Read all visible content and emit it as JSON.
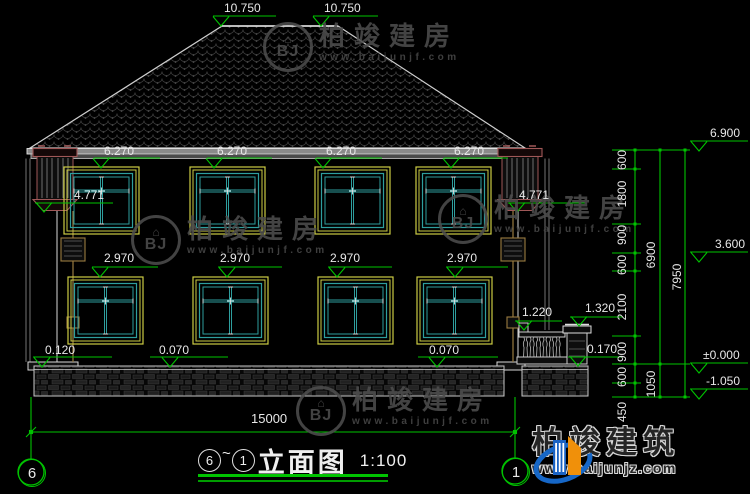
{
  "canvas": {
    "width": 750,
    "height": 494
  },
  "colors": {
    "background": "#000000",
    "dimension_green": "#00c300",
    "text_white": "#e8e8e8",
    "window_frame_yellow": "#cccc44",
    "window_frame_teal": "#2e9e9e",
    "pilaster_brown": "#a05858",
    "downspout_brown": "#9a7b40",
    "watermark_gray": "#4d4d4d",
    "brand_blue": "#1667c7",
    "brand_orange": "#f0900a"
  },
  "marks": {
    "ridge": [
      "10.750",
      "10.750"
    ],
    "eave": [
      "6.270",
      "6.270",
      "6.270",
      "6.270"
    ],
    "pilaster_left": "4.771",
    "pilaster_right": "4.771",
    "floor2": [
      "2.970",
      "2.970",
      "2.970",
      "2.970"
    ],
    "base": "0.120",
    "floor1": [
      "0.070",
      "0.070"
    ],
    "fence_rail": "1.220",
    "fence_pillar": "1.320",
    "fence_base": "0.170"
  },
  "dims": {
    "total_width": "15000",
    "chain": [
      "600",
      "1800",
      "900",
      "600",
      "2100",
      "900",
      "600",
      "450"
    ],
    "subtotals": [
      "6900",
      "1050"
    ],
    "total_height": "7950",
    "levels": [
      "6.900",
      "3.600",
      "±0.000",
      "-1.050"
    ]
  },
  "grid": {
    "left": "6",
    "right": "1"
  },
  "title": {
    "from": "6",
    "separator": "~",
    "to": "1",
    "label": "立面图",
    "scale": "1:100"
  },
  "watermark": {
    "house_glyph": "⌂",
    "monogram": "BJ",
    "name": "柏竣建房",
    "url": "www.baijunjf.com"
  },
  "brand": {
    "name": "柏竣建筑",
    "url": "www.baijunjz.com"
  }
}
